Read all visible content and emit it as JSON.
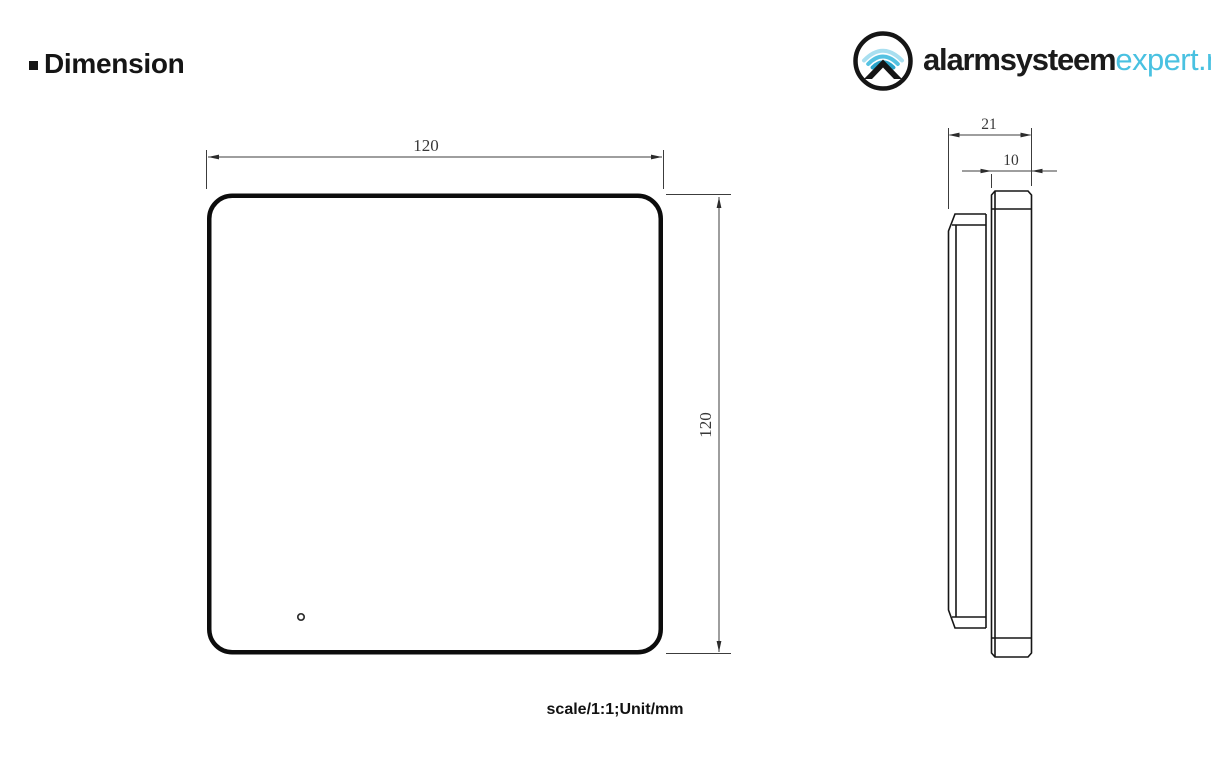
{
  "header": {
    "bullet": "▪",
    "title": "Dimension"
  },
  "logo": {
    "brand_bold": "alarmsysteem",
    "brand_accent": "expert.nl",
    "accent_color": "#49c1e1",
    "wave_colors": [
      "#a8dff0",
      "#55c2e2",
      "#2aa3c9"
    ],
    "icon_name": "wifi-roof-circle-icon"
  },
  "front_view": {
    "width_mm": "120",
    "height_mm": "120"
  },
  "side_view": {
    "depth_mm": "21",
    "panel_thickness_mm": "10"
  },
  "footer": {
    "note": "scale/1:1;Unit/mm"
  },
  "colors": {
    "outline": "#0c0c0c",
    "profile_line": "#161616",
    "dim_line": "#3c3c3c",
    "background": "#ffffff"
  }
}
